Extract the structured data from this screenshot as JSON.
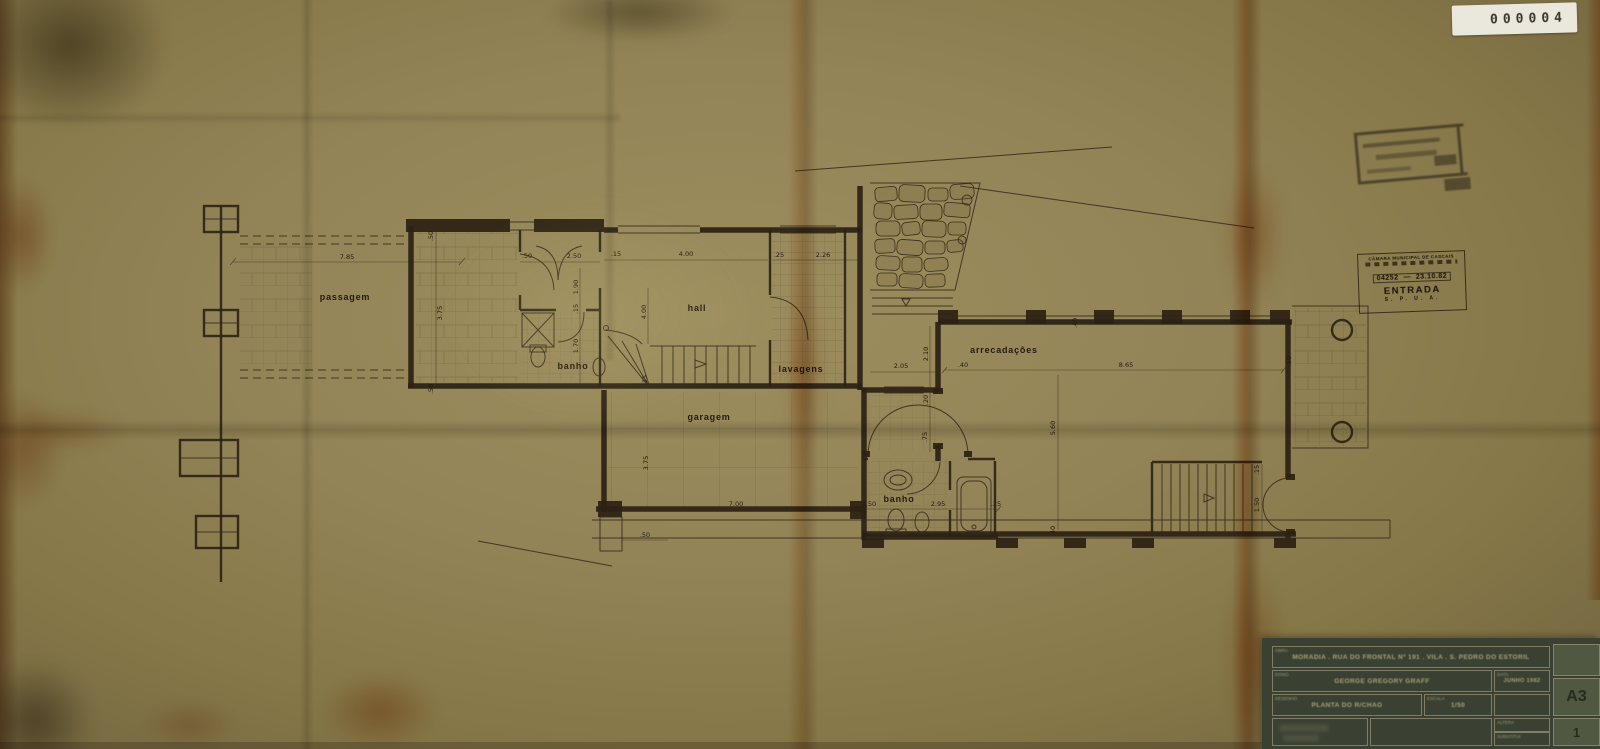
{
  "sticker": {
    "number": "000004"
  },
  "stamps": {
    "entry": {
      "line1": "CÂMARA MUNICIPAL DE CASCAIS",
      "number": "04252",
      "date": "23.10.82",
      "big": "ENTRADA",
      "bottom": "S. P. U. A."
    }
  },
  "plan": {
    "rooms": [
      "passagem",
      "banho",
      "hall",
      "lavagens",
      "garagem",
      "arrecadações",
      "banho"
    ],
    "dims": [
      "7.85",
      ".50",
      "3.75",
      ".50",
      ".50",
      "2.50",
      "1.90",
      ".15",
      "1.70",
      ".15",
      "4.00",
      ".25",
      "2.26",
      "4.00",
      ".25",
      "3.75",
      "7.00",
      ".50",
      "2.95",
      ".25",
      ".50",
      "2.05",
      "2.10",
      ".20",
      ".75",
      ".40",
      "8.65",
      ".40",
      "5.60",
      ".40",
      ".50",
      ".15",
      "1.50"
    ]
  },
  "titleblock": {
    "obra_label": "OBRA",
    "obra": "MORADIA . RUA DO FRONTAL Nº 191 . VILA . S. PEDRO DO ESTORIL",
    "dono_label": "DONO",
    "dono": "GEORGE GREGORY GRAFF",
    "data_label": "DATA",
    "data": "JUNHO 1982",
    "desenho_label": "DESENHO",
    "desenho": "PLANTA DO R/CHÃO",
    "escala_label": "ESCALA",
    "escala": "1/50",
    "altera_label": "ALTERA",
    "substitui_label": "SUBSTITUI",
    "formato": "A3",
    "folha": "1"
  }
}
